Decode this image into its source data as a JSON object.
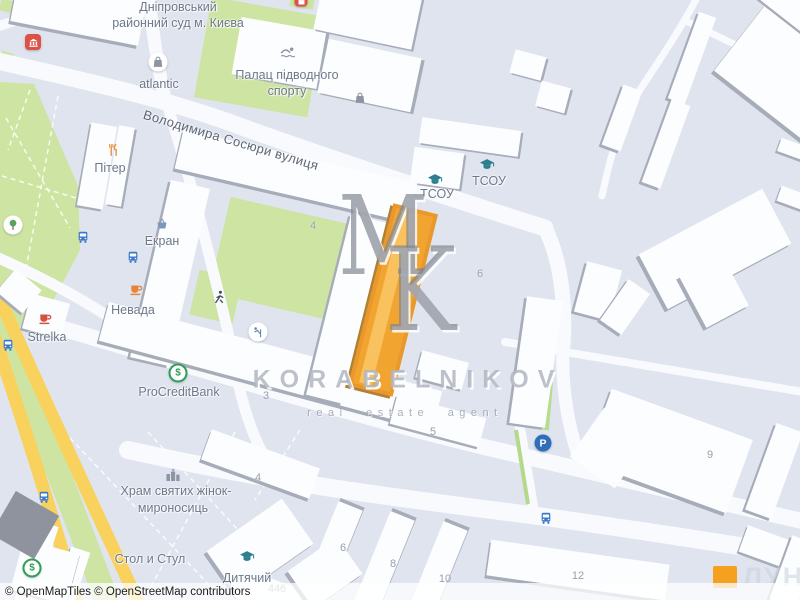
{
  "map": {
    "street_label": {
      "text": "Володимира Сосюри вулиця",
      "x": 231,
      "y": 140,
      "rotation": 16.5
    },
    "place_labels": [
      {
        "text": "Дніпровський",
        "x": 178,
        "y": 7
      },
      {
        "text": "районний суд м. Києва",
        "x": 178,
        "y": 23
      },
      {
        "text": "atlantic",
        "x": 159,
        "y": 84
      },
      {
        "text": "Палац підводного",
        "x": 287,
        "y": 75
      },
      {
        "text": "спорту",
        "x": 287,
        "y": 91
      },
      {
        "text": "Пітер",
        "x": 110,
        "y": 168
      },
      {
        "text": "Екран",
        "x": 162,
        "y": 241
      },
      {
        "text": "Невада",
        "x": 133,
        "y": 310
      },
      {
        "text": "Strelka",
        "x": 47,
        "y": 337
      },
      {
        "text": "ProCreditBank",
        "x": 179,
        "y": 392
      },
      {
        "text": "ТСОУ",
        "x": 437,
        "y": 194
      },
      {
        "text": "ТСОУ",
        "x": 489,
        "y": 181
      },
      {
        "text": "Храм святих жінок-",
        "x": 176,
        "y": 491
      },
      {
        "text": "мироносиць",
        "x": 173,
        "y": 508
      },
      {
        "text": "Стол и Стул",
        "x": 150,
        "y": 559
      },
      {
        "text": "Дитячий",
        "x": 247,
        "y": 578
      }
    ],
    "house_numbers": [
      {
        "text": "4",
        "x": 313,
        "y": 226
      },
      {
        "text": "6",
        "x": 480,
        "y": 274
      },
      {
        "text": "3",
        "x": 266,
        "y": 396
      },
      {
        "text": "5",
        "x": 433,
        "y": 432
      },
      {
        "text": "4",
        "x": 258,
        "y": 478
      },
      {
        "text": "6",
        "x": 343,
        "y": 548
      },
      {
        "text": "8",
        "x": 393,
        "y": 564
      },
      {
        "text": "10",
        "x": 445,
        "y": 579
      },
      {
        "text": "12",
        "x": 578,
        "y": 576
      },
      {
        "text": "9",
        "x": 710,
        "y": 455
      },
      {
        "text": "446",
        "x": 277,
        "y": 589
      }
    ],
    "poi_icons": [
      {
        "icon": "courthouse",
        "x": 33,
        "y": 42,
        "color": "#ffffff",
        "chip": "red"
      },
      {
        "icon": "shop",
        "x": 301,
        "y": 1,
        "color": "#ffffff",
        "chip": "red-small"
      },
      {
        "icon": "shopping-bag",
        "x": 158,
        "y": 62,
        "color": "#8d94a2",
        "chip": "circle"
      },
      {
        "icon": "swimmer",
        "x": 288,
        "y": 52,
        "color": "#8d94a2"
      },
      {
        "icon": "shopping-bag",
        "x": 360,
        "y": 98,
        "color": "#8d94a2"
      },
      {
        "icon": "restaurant",
        "x": 113,
        "y": 150,
        "color": "#e8913f"
      },
      {
        "icon": "bus",
        "x": 83,
        "y": 237,
        "color": "#3c78c9"
      },
      {
        "icon": "bus",
        "x": 133,
        "y": 257,
        "color": "#3c78c9"
      },
      {
        "icon": "bus",
        "x": 8,
        "y": 345,
        "color": "#3c78c9"
      },
      {
        "icon": "bus",
        "x": 44,
        "y": 497,
        "color": "#3c78c9"
      },
      {
        "icon": "bus",
        "x": 546,
        "y": 518,
        "color": "#3c78c9"
      },
      {
        "icon": "shop-basket",
        "x": 162,
        "y": 224,
        "color": "#7d96bb"
      },
      {
        "icon": "coffee-cup",
        "x": 136,
        "y": 289,
        "color": "#e8833a"
      },
      {
        "icon": "coffee-cup",
        "x": 45,
        "y": 318,
        "color": "#d2523f"
      },
      {
        "icon": "tree",
        "x": 13,
        "y": 225,
        "color": "#58a15e",
        "chip": "circle"
      },
      {
        "icon": "playground-runner",
        "x": 219,
        "y": 297,
        "color": "#3f4a55"
      },
      {
        "icon": "playground-slide",
        "x": 258,
        "y": 332,
        "color": "#5e87b0",
        "chip": "circle"
      },
      {
        "icon": "bank-dollar",
        "x": 178,
        "y": 373,
        "color": "#2f9e57",
        "chip": "ring"
      },
      {
        "icon": "bank-dollar",
        "x": 32,
        "y": 568,
        "color": "#2f9e57",
        "chip": "ring"
      },
      {
        "icon": "graduation-cap",
        "x": 435,
        "y": 180,
        "color": "#2e7f8e"
      },
      {
        "icon": "graduation-cap",
        "x": 487,
        "y": 165,
        "color": "#2e7f8e"
      },
      {
        "icon": "graduation-cap",
        "x": 247,
        "y": 557,
        "color": "#2e7f8e"
      },
      {
        "icon": "church",
        "x": 173,
        "y": 474,
        "color": "#8d94a2"
      },
      {
        "icon": "parking",
        "x": 543,
        "y": 443,
        "color": "#ffffff",
        "chip": "blue"
      }
    ]
  },
  "watermark": {
    "monogram_m": "M",
    "monogram_k": "K",
    "brand": "KORABELNIKOV",
    "tagline": "real estate agent"
  },
  "logo": {
    "text": "ЛУН"
  },
  "attribution": {
    "text": "© OpenMapTiles © OpenStreetMap contributors"
  },
  "colors": {
    "background": "#dfe4ef",
    "building": "#fcfdff",
    "building_shadow": "#a6acb8",
    "park": "#cde4a2",
    "highway": "#f8d25c",
    "highlight_building": "#f2a431"
  }
}
